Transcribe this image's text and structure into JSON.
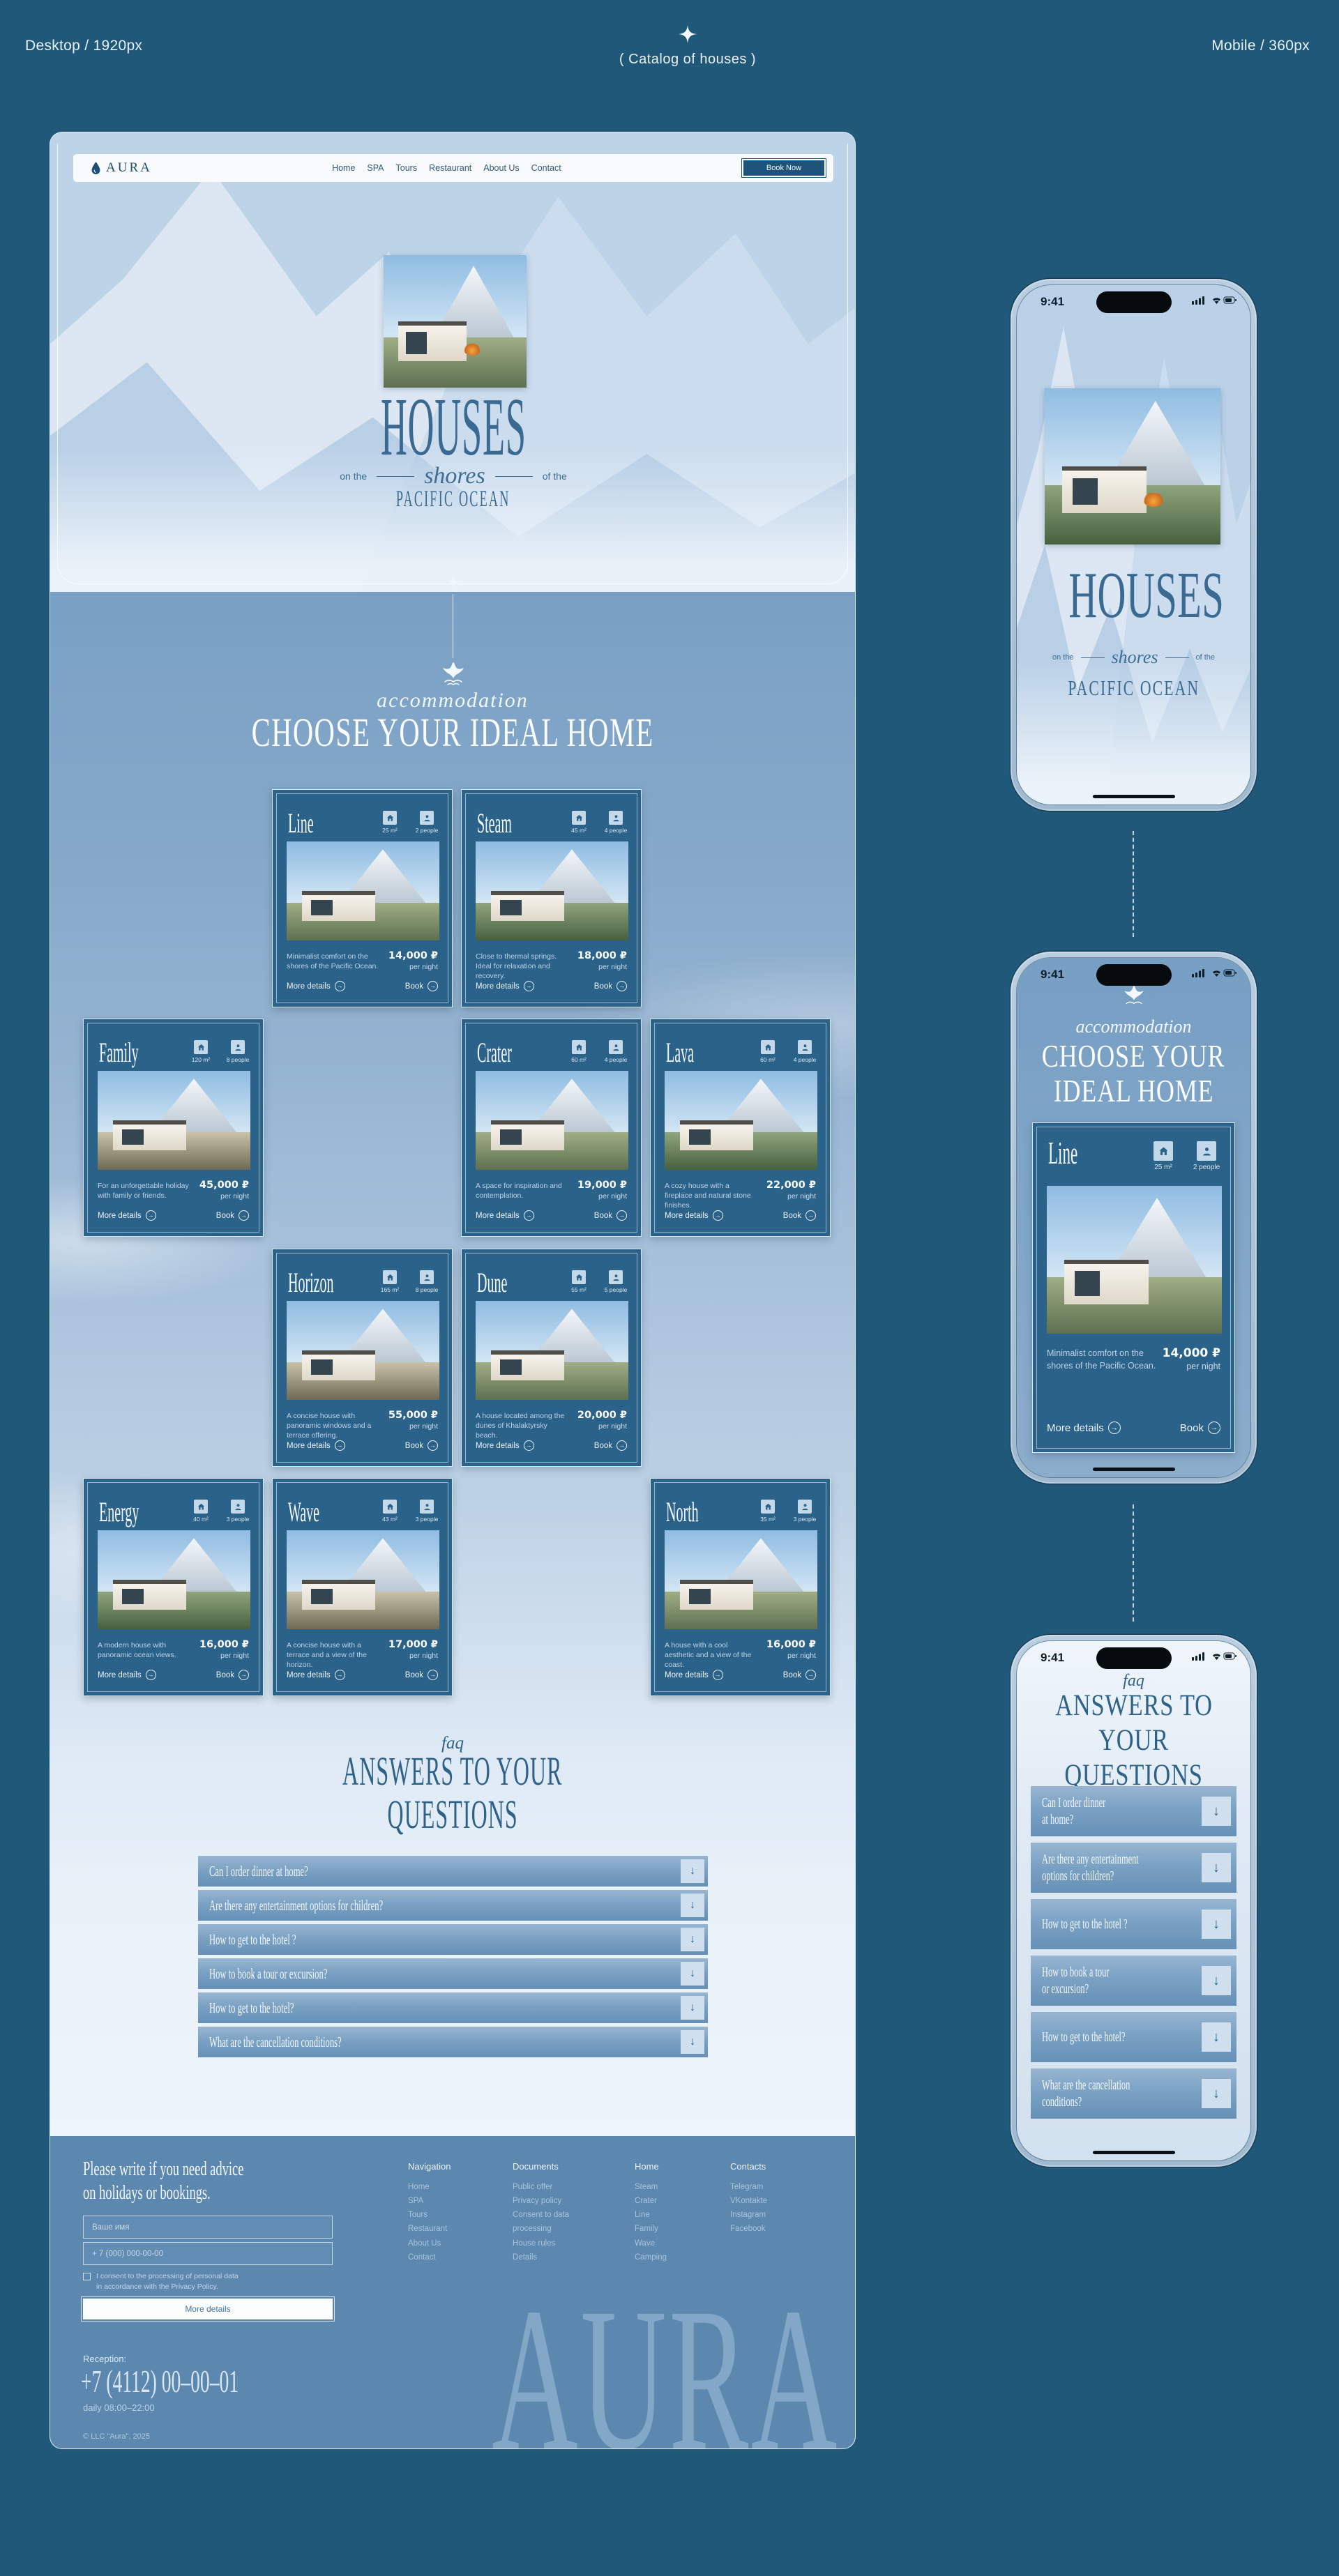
{
  "annotations": {
    "desktop_label": "Desktop / 1920px",
    "mobile_label": "Mobile / 360px",
    "center_label": "(  Catalog of houses  )"
  },
  "colors": {
    "page_bg": "#1F5878",
    "card_bg": "#2B628A",
    "footer_bg": "#5C88B0",
    "heading_dark": "#2E6288",
    "hero_text": "#3A6A92"
  },
  "icons": {
    "arrow": "→",
    "arrow_down": "↓",
    "sparkle": "sparkle-icon",
    "whale": "whale-tail-icon",
    "logo_drop": "water-drop-icon"
  },
  "phone": {
    "time": "9:41",
    "faq_mobile": [
      [
        "Can I order dinner",
        "at home?"
      ],
      [
        "Are there any entertainment",
        "options for children?"
      ],
      [
        "How to get to the hotel ?"
      ],
      [
        "How to book a tour",
        "or excursion?"
      ],
      [
        "How to get to the hotel?"
      ],
      [
        "What are the cancellation",
        "conditions?"
      ]
    ]
  },
  "site": {
    "brand": "AURA",
    "nav": [
      "Home",
      "SPA",
      "Tours",
      "Restaurant",
      "About Us",
      "Contact"
    ],
    "book_now": "Book Now",
    "hero": {
      "title": "HOUSES",
      "sub_left": "on the",
      "sub_script": "shores",
      "sub_right": "of the",
      "subtitle": "PACIFIC OCEAN"
    },
    "accommodation": {
      "eyebrow": "accommodation",
      "heading": "CHOOSE YOUR IDEAL HOME",
      "m_l1": "CHOOSE YOUR",
      "m_l2": "IDEAL HOME"
    },
    "card_links": {
      "more": "More details",
      "book": "Book",
      "per_night": "per night"
    },
    "cards": [
      {
        "name": "Line",
        "area": "25 m²",
        "people": "2 people",
        "desc": "Minimalist comfort on the shores of the Pacific Ocean.",
        "price": "14,000 ₽",
        "row": 1,
        "col": 2
      },
      {
        "name": "Steam",
        "area": "45 m²",
        "people": "4 people",
        "desc": "Close to thermal springs. Ideal for relaxation and recovery.",
        "price": "18,000 ₽",
        "row": 1,
        "col": 3
      },
      {
        "name": "Family",
        "area": "120 m²",
        "people": "8 people",
        "desc": "For an unforgettable holiday with family or friends.",
        "price": "45,000 ₽",
        "row": 2,
        "col": 1
      },
      {
        "name": "Crater",
        "area": "60 m²",
        "people": "4 people",
        "desc": "A space for inspiration and contemplation.",
        "price": "19,000 ₽",
        "row": 2,
        "col": 3
      },
      {
        "name": "Lava",
        "area": "60 m²",
        "people": "4 people",
        "desc": "A cozy house with a fireplace and natural stone finishes.",
        "price": "22,000 ₽",
        "row": 2,
        "col": 4
      },
      {
        "name": "Horizon",
        "area": "165 m²",
        "people": "8 people",
        "desc": "A concise house with panoramic windows and a terrace offering.",
        "price": "55,000 ₽",
        "row": 3,
        "col": 2
      },
      {
        "name": "Dune",
        "area": "55 m²",
        "people": "5 people",
        "desc": "A house located among the dunes of Khalaktyrsky beach.",
        "price": "20,000 ₽",
        "row": 3,
        "col": 3
      },
      {
        "name": "Energy",
        "area": "40 m²",
        "people": "3 people",
        "desc": "A modern house with panoramic ocean views.",
        "price": "16,000 ₽",
        "row": 4,
        "col": 1
      },
      {
        "name": "Wave",
        "area": "43 m²",
        "people": "3 people",
        "desc": "A concise house with a terrace and a view of the horizon.",
        "price": "17,000 ₽",
        "row": 4,
        "col": 2
      },
      {
        "name": "North",
        "area": "35 m²",
        "people": "3 people",
        "desc": "A house with a cool aesthetic and a view of the coast.",
        "price": "16,000 ₽",
        "row": 4,
        "col": 4
      }
    ],
    "faq": {
      "eyebrow": "faq",
      "heading_l1": "ANSWERS TO YOUR",
      "heading_l2": "QUESTIONS",
      "m_l1": "ANSWERS TO",
      "m_l2": "YOUR QUESTIONS",
      "questions": [
        "Can I order dinner at home?",
        "Are there any entertainment options for children?",
        "How to get to the hotel ?",
        "How to book a tour or excursion?",
        "How to get to the hotel?",
        "What are the cancellation conditions?"
      ]
    },
    "footer": {
      "heading_l1": "Please write if you need advice",
      "heading_l2": "on holidays or bookings.",
      "name_placeholder": "Ваше имя",
      "phone_placeholder": "+ 7 (000) 000-00-00",
      "consent_l1": "I consent to the processing of personal data",
      "consent_l2": "in accordance with the Privacy Policy.",
      "submit": "More details",
      "reception_label": "Reception:",
      "phone": "+7 (4112) 00–00–01",
      "hours": "daily 08:00–22:00",
      "copyright": "© LLC \"Aura\", 2025",
      "watermark": "AURA",
      "columns": [
        {
          "title": "Navigation",
          "items": [
            "Home",
            "SPA",
            "Tours",
            "Restaurant",
            "About Us",
            "Contact"
          ]
        },
        {
          "title": "Documents",
          "items": [
            "Public offer",
            "Privacy policy",
            "Consent to data processing",
            "House rules",
            "Details"
          ]
        },
        {
          "title": "Home",
          "items": [
            "Steam",
            "Crater",
            "Line",
            "Family",
            "Wave",
            "Camping"
          ]
        },
        {
          "title": "Contacts",
          "items": [
            "Telegram",
            "VKontakte",
            "Instagram",
            "Facebook"
          ]
        }
      ]
    }
  }
}
